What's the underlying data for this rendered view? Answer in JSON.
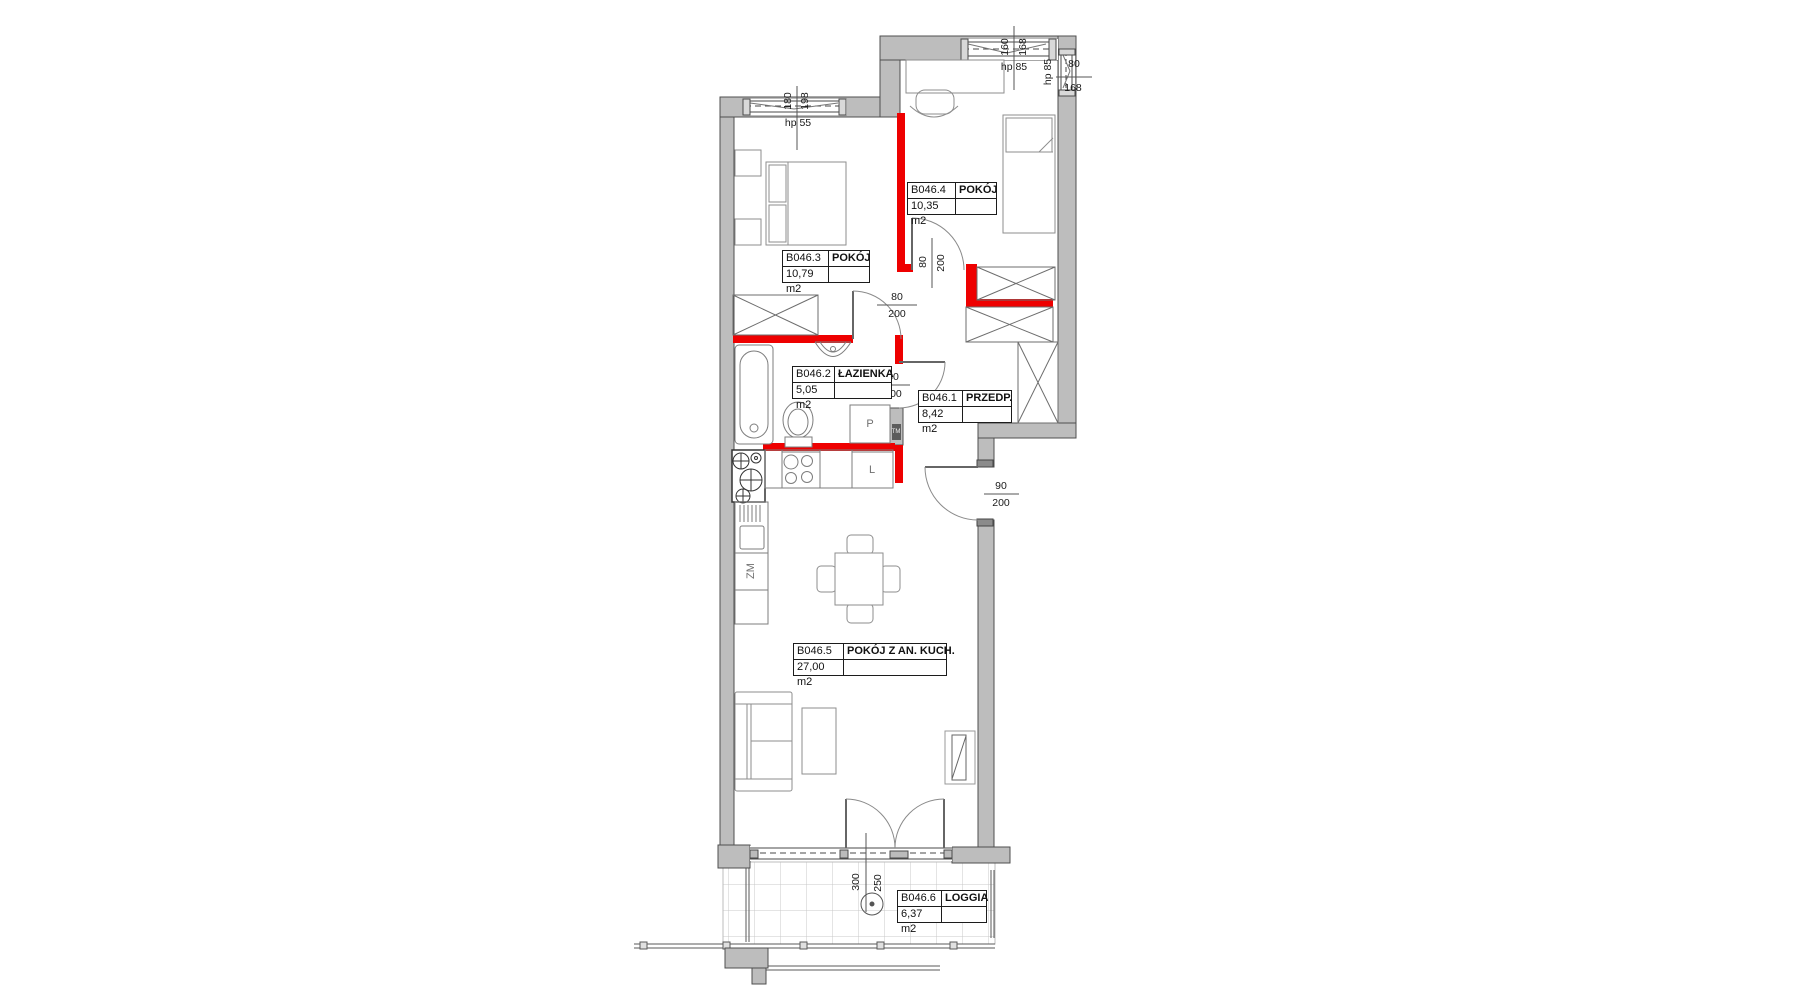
{
  "plan": {
    "rooms": [
      {
        "id": "B046.3",
        "name": "POKÓJ",
        "area": "10,79 m2"
      },
      {
        "id": "B046.4",
        "name": "POKÓJ",
        "area": "10,35 m2"
      },
      {
        "id": "B046.2",
        "name": "ŁAZIENKA",
        "area": "5,05 m2"
      },
      {
        "id": "B046.1",
        "name": "PRZEDP.",
        "area": "8,42 m2"
      },
      {
        "id": "B046.5",
        "name": "POKÓJ Z AN. KUCH.",
        "area": "27,00 m2"
      },
      {
        "id": "B046.6",
        "name": "LOGGIA",
        "area": "6,37 m2"
      }
    ],
    "window_dims": {
      "w1_width": "180",
      "w1_height": "198",
      "w1_sill": "hp 55",
      "w2_width": "160",
      "w2_height": "168",
      "w2_sill": "hp 85",
      "w3_width": "80",
      "w3_height": "168",
      "w3_sill": "hp 85"
    },
    "door_dims": {
      "room3_width": "80",
      "room3_height": "200",
      "room4_width": "80",
      "room4_height": "200",
      "bath_width": "80",
      "bath_height": "200",
      "entry_width": "90",
      "entry_height": "200",
      "loggia_width": "300",
      "loggia_height": "250"
    },
    "appliances": {
      "washer": "P",
      "fridge": "L",
      "dishwasher": "ZM",
      "meter": "TM"
    },
    "colors": {
      "wall_fill": "#bdbdbd",
      "red_wall": "#ee0000"
    }
  }
}
